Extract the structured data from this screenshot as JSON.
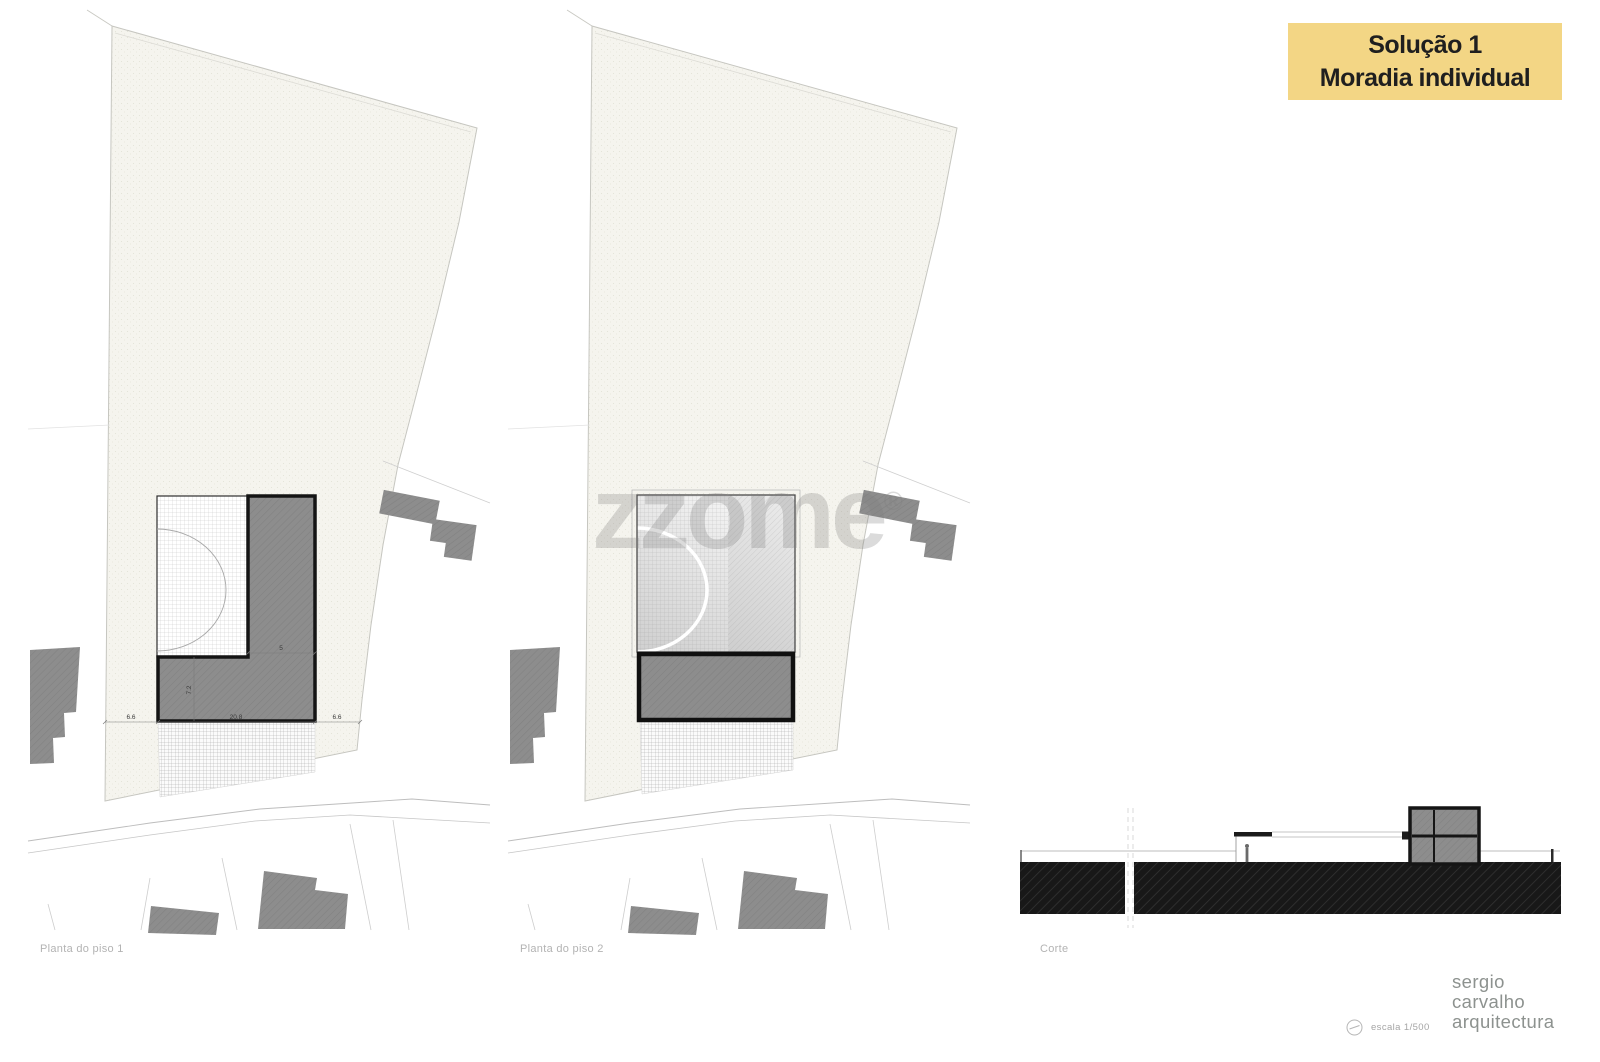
{
  "title_box": {
    "line1": "Solução 1",
    "line2": "Moradia individual"
  },
  "watermark": {
    "text": "zzome",
    "registered": "®"
  },
  "plans": {
    "plan1": {
      "caption": "Planta do piso 1",
      "dims": {
        "left": "6.6",
        "width": "20.8",
        "right": "6.6",
        "depth": "7.2",
        "wing": "5"
      }
    },
    "plan2": {
      "caption": "Planta do piso 2"
    },
    "section": {
      "caption": "Corte"
    }
  },
  "footer": {
    "scale_label": "escala 1/500",
    "logo_lines": [
      "sergio",
      "carvalho",
      "arquitectura"
    ]
  },
  "colors": {
    "title_bg": "#f3d685",
    "title_text": "#1f1f1f",
    "building_grey": "#8d8d8d",
    "section_slab": "#181818",
    "parcel_beige": "#f5f4ee"
  }
}
